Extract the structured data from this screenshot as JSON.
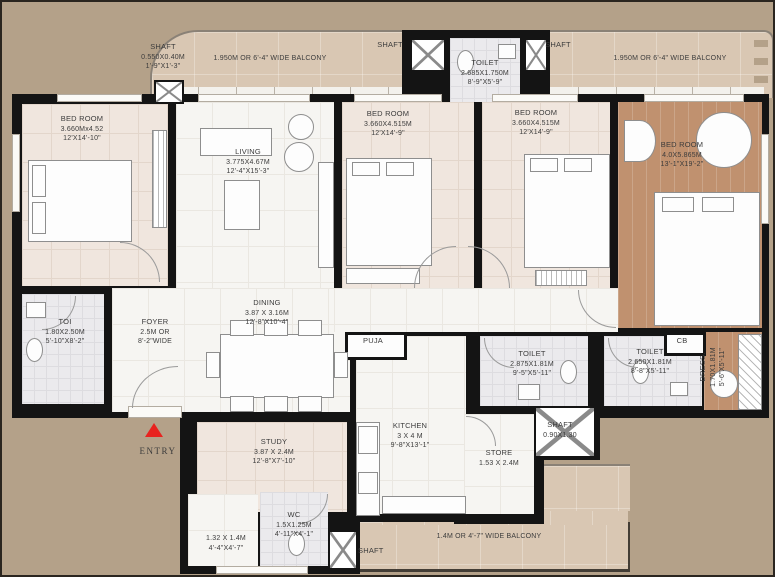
{
  "colors": {
    "background_tan": "#b4a189",
    "balcony_beige": "#d9c7b3",
    "wall_black": "#141414",
    "bedroom_floor": "#f0e6de",
    "marble_floor": "#f6f5f2",
    "tile_floor": "#ebeaed",
    "wood_floor": "#c0916f",
    "entry_red": "#e8231f",
    "text": "#3c3c3c"
  },
  "labels": {
    "shaft_top_left": {
      "name": "SHAFT",
      "m": "0.550X0.40M",
      "ft": "1'-9\"X1'-3\""
    },
    "balcony_top_left": {
      "name": "1.950M OR 6'-4\" WIDE BALCONY"
    },
    "shaft_t1": {
      "name": "SHAFT"
    },
    "toilet_top": {
      "name": "TOILET",
      "m": "2.685X1.750M",
      "ft": "8'-9\"X5'-9\""
    },
    "shaft_t2": {
      "name": "SHAFT"
    },
    "balcony_top_right": {
      "name": "1.950M OR 6'-4\" WIDE BALCONY"
    },
    "bedroom1": {
      "name": "BED ROOM",
      "m": "3.660Mx4.52",
      "ft": "12'X14'-10\""
    },
    "living": {
      "name": "LIVING",
      "m": "3.775X4.67M",
      "ft": "12'-4\"X15'-3\""
    },
    "bedroom2": {
      "name": "BED ROOM",
      "m": "3.660X4.515M",
      "ft": "12'X14'-9\""
    },
    "bedroom3": {
      "name": "BED ROOM",
      "m": "3.660X4.515M",
      "ft": "12'X14'-9\""
    },
    "master_bedroom": {
      "name": "BED ROOM",
      "m": "4.0X5.865M",
      "ft": "13'-1\"X19'-2\""
    },
    "toi": {
      "name": "TOI",
      "m": "1.80X2.50M",
      "ft": "5'-10\"X8'-2\""
    },
    "foyer": {
      "name": "FOYER",
      "m": "2.5M OR",
      "ft": "8'-2\"WIDE"
    },
    "dining": {
      "name": "DINING",
      "m": "3.87 X 3.16M",
      "ft": "12'-8\"X10'-4\""
    },
    "puja": {
      "name": "PUJA"
    },
    "kitchen": {
      "name": "KITCHEN",
      "m": "3 X 4 M",
      "ft": "9'-8\"X13'-1\""
    },
    "toilet_mid": {
      "name": "TOILET",
      "m": "2.875X1.81M",
      "ft": "9'-5\"X5'-11\""
    },
    "toilet_right": {
      "name": "TOILET",
      "m": "2.650X1.81M",
      "ft": "8'-8\"X5'-11\""
    },
    "cb": {
      "name": "CB"
    },
    "dress": {
      "name": "DRESS.",
      "m": "1.70X1.81M",
      "ft": "5'-6\"X5'-11\""
    },
    "entry": {
      "name": "ENTRY"
    },
    "study": {
      "name": "STUDY",
      "m": "3.87 X 2.4M",
      "ft": "12'-8\"X7'-10\""
    },
    "utility_small": {
      "m": "1.32 X 1.4M",
      "ft": "4'-4\"X4'-7\""
    },
    "wc": {
      "name": "WC",
      "m": "1.5X1.25M",
      "ft": "4'-11\"X4'-1\""
    },
    "shaft_mid": {
      "name": "SHAFT",
      "m": "0.90X1.30"
    },
    "store": {
      "name": "STORE",
      "m": "1.53 X 2.4M"
    },
    "shaft_bottom": {
      "name": "SHAFT"
    },
    "balcony_bottom": {
      "name": "1.4M OR 4'-7\" WIDE BALCONY"
    }
  }
}
